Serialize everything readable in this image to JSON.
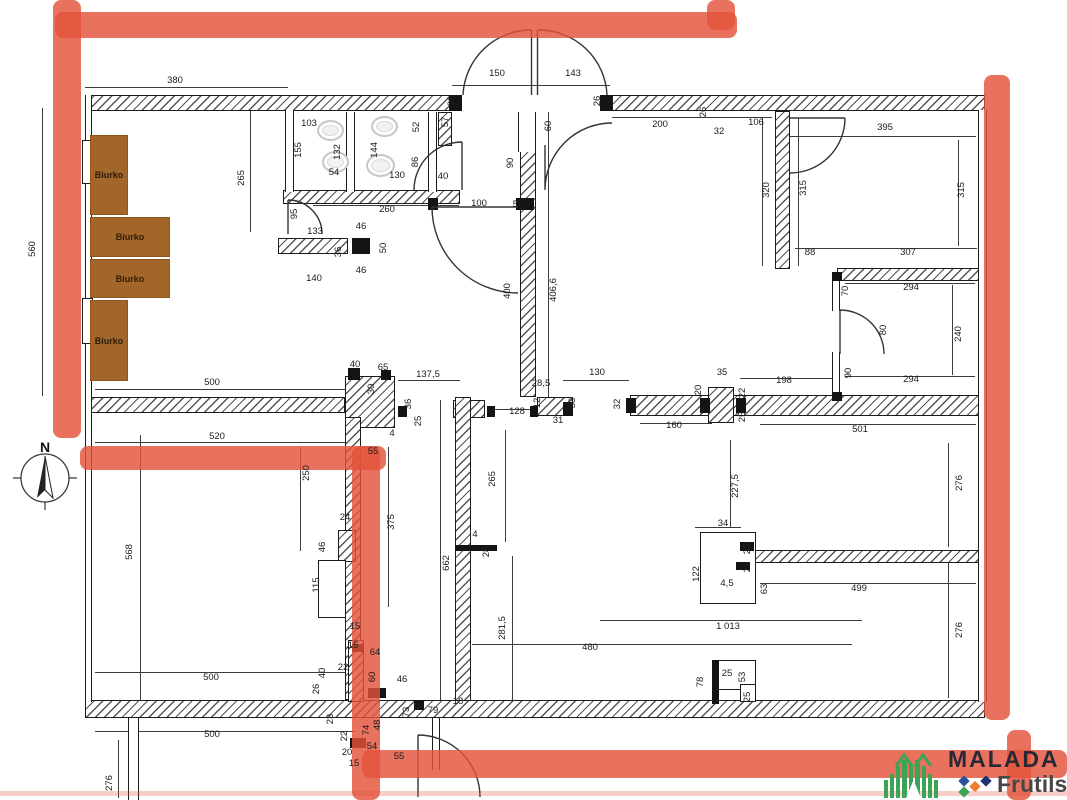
{
  "drawing": {
    "type": "floor-plan",
    "compass": {
      "label": "N"
    },
    "desk_label": "Biurko",
    "desks": [
      {
        "label": "Biurko",
        "x": 90,
        "y": 135,
        "w": 38,
        "h": 80
      },
      {
        "label": "Biurko",
        "x": 90,
        "y": 217,
        "w": 80,
        "h": 40
      },
      {
        "label": "Biurko",
        "x": 90,
        "y": 259,
        "w": 80,
        "h": 39
      },
      {
        "label": "Biurko",
        "x": 90,
        "y": 300,
        "w": 38,
        "h": 81
      }
    ],
    "dimensions": [
      [
        "380",
        175,
        81,
        0
      ],
      [
        "150",
        497,
        74,
        0
      ],
      [
        "143",
        573,
        74,
        0
      ],
      [
        "26",
        452,
        101,
        1
      ],
      [
        "26",
        598,
        101,
        1
      ],
      [
        "200",
        660,
        125,
        0
      ],
      [
        "32",
        719,
        132,
        0
      ],
      [
        "106",
        756,
        123,
        0
      ],
      [
        "26",
        704,
        112,
        1
      ],
      [
        "395",
        885,
        128,
        0
      ],
      [
        "320",
        767,
        190,
        1
      ],
      [
        "315",
        804,
        188,
        1
      ],
      [
        "315",
        962,
        190,
        1
      ],
      [
        "103",
        309,
        124,
        0
      ],
      [
        "155",
        299,
        150,
        1
      ],
      [
        "132",
        338,
        152,
        1
      ],
      [
        "54",
        334,
        173,
        0
      ],
      [
        "144",
        375,
        150,
        1
      ],
      [
        "52",
        417,
        127,
        1
      ],
      [
        "57",
        446,
        122,
        1
      ],
      [
        "86",
        416,
        162,
        1
      ],
      [
        "130",
        397,
        176,
        0
      ],
      [
        "40",
        443,
        177,
        0
      ],
      [
        "90",
        511,
        163,
        1
      ],
      [
        "60",
        549,
        126,
        1
      ],
      [
        "100",
        479,
        204,
        0
      ],
      [
        "50",
        518,
        205,
        0
      ],
      [
        "260",
        387,
        210,
        0
      ],
      [
        "95",
        295,
        214,
        1
      ],
      [
        "133",
        315,
        232,
        0
      ],
      [
        "46",
        361,
        227,
        0
      ],
      [
        "36",
        339,
        252,
        1
      ],
      [
        "50",
        384,
        248,
        1
      ],
      [
        "46",
        361,
        271,
        0
      ],
      [
        "140",
        314,
        279,
        0
      ],
      [
        "265",
        242,
        178,
        1
      ],
      [
        "560",
        33,
        249,
        1
      ],
      [
        "88",
        810,
        253,
        0
      ],
      [
        "307",
        908,
        253,
        0
      ],
      [
        "294",
        911,
        288,
        0
      ],
      [
        "70",
        846,
        291,
        1
      ],
      [
        "80",
        884,
        330,
        1
      ],
      [
        "240",
        959,
        334,
        1
      ],
      [
        "90",
        849,
        373,
        1
      ],
      [
        "294",
        911,
        380,
        0
      ],
      [
        "198",
        784,
        381,
        0
      ],
      [
        "400",
        508,
        291,
        1
      ],
      [
        "406,6",
        554,
        290,
        1
      ],
      [
        "130",
        597,
        373,
        0
      ],
      [
        "28,5",
        541,
        384,
        0
      ],
      [
        "128",
        517,
        412,
        0
      ],
      [
        "12",
        538,
        403,
        1
      ],
      [
        "33",
        573,
        403,
        1
      ],
      [
        "31",
        558,
        421,
        0
      ],
      [
        "32",
        618,
        404,
        1
      ],
      [
        "35",
        722,
        373,
        0
      ],
      [
        "20",
        699,
        390,
        1
      ],
      [
        "22",
        743,
        393,
        1
      ],
      [
        "25",
        743,
        417,
        1
      ],
      [
        "160",
        674,
        426,
        0
      ],
      [
        "501",
        860,
        430,
        0
      ],
      [
        "40",
        355,
        365,
        0
      ],
      [
        "65",
        383,
        368,
        0
      ],
      [
        "30",
        372,
        389,
        1
      ],
      [
        "137,5",
        428,
        375,
        0
      ],
      [
        "36",
        409,
        404,
        1
      ],
      [
        "25",
        419,
        421,
        1
      ],
      [
        "4",
        392,
        434,
        0
      ],
      [
        "500",
        212,
        383,
        0
      ],
      [
        "520",
        217,
        437,
        0
      ],
      [
        "55",
        373,
        452,
        0
      ],
      [
        "250",
        307,
        473,
        1
      ],
      [
        "375",
        392,
        522,
        1
      ],
      [
        "24",
        345,
        518,
        0
      ],
      [
        "46",
        323,
        547,
        1
      ],
      [
        "115",
        317,
        585,
        1
      ],
      [
        "15",
        355,
        627,
        0
      ],
      [
        "568",
        130,
        552,
        1
      ],
      [
        "265",
        493,
        479,
        1
      ],
      [
        "662",
        447,
        563,
        1
      ],
      [
        "4",
        475,
        535,
        0
      ],
      [
        "28",
        487,
        552,
        1
      ],
      [
        "281,5",
        503,
        628,
        1
      ],
      [
        "227,5",
        736,
        486,
        1
      ],
      [
        "34",
        723,
        524,
        0
      ],
      [
        "23",
        748,
        549,
        1
      ],
      [
        "25",
        748,
        567,
        1
      ],
      [
        "122",
        697,
        574,
        1
      ],
      [
        "4,5",
        727,
        584,
        0
      ],
      [
        "63",
        765,
        589,
        1
      ],
      [
        "499",
        859,
        589,
        0
      ],
      [
        "276",
        960,
        483,
        1
      ],
      [
        "1 013",
        728,
        627,
        0
      ],
      [
        "480",
        590,
        648,
        0
      ],
      [
        "276",
        960,
        630,
        1
      ],
      [
        "78",
        701,
        682,
        1
      ],
      [
        "25",
        727,
        674,
        0
      ],
      [
        "53",
        743,
        677,
        1
      ],
      [
        "25",
        748,
        697,
        1
      ],
      [
        "500",
        211,
        678,
        0
      ],
      [
        "500",
        212,
        735,
        0
      ],
      [
        "276",
        110,
        783,
        1
      ],
      [
        "15",
        353,
        646,
        0
      ],
      [
        "64",
        375,
        653,
        0
      ],
      [
        "40",
        323,
        673,
        1
      ],
      [
        "26",
        317,
        689,
        1
      ],
      [
        "22",
        343,
        668,
        0
      ],
      [
        "60",
        373,
        677,
        1
      ],
      [
        "46",
        402,
        680,
        0
      ],
      [
        "23",
        331,
        719,
        1
      ],
      [
        "22",
        345,
        736,
        1
      ],
      [
        "74",
        367,
        730,
        1
      ],
      [
        "48",
        378,
        725,
        1
      ],
      [
        "73",
        407,
        712,
        1
      ],
      [
        "79",
        433,
        711,
        0
      ],
      [
        "18",
        458,
        702,
        0
      ],
      [
        "54",
        372,
        747,
        0
      ],
      [
        "20",
        347,
        753,
        0
      ],
      [
        "15",
        354,
        764,
        0
      ],
      [
        "55",
        399,
        757,
        0
      ]
    ],
    "logo": {
      "brand": "MALADA",
      "sub": "Frutils"
    },
    "colors": {
      "highlight_red": "#e4533a",
      "desk_brown": "#a2662b",
      "logo_green": "#3aa457",
      "brand_dark": "#2b2836",
      "diamond_blue": "#2e4f9e",
      "diamond_green": "#3aa457",
      "diamond_orange": "#ee7e2e",
      "diamond_navy": "#20306b"
    }
  }
}
